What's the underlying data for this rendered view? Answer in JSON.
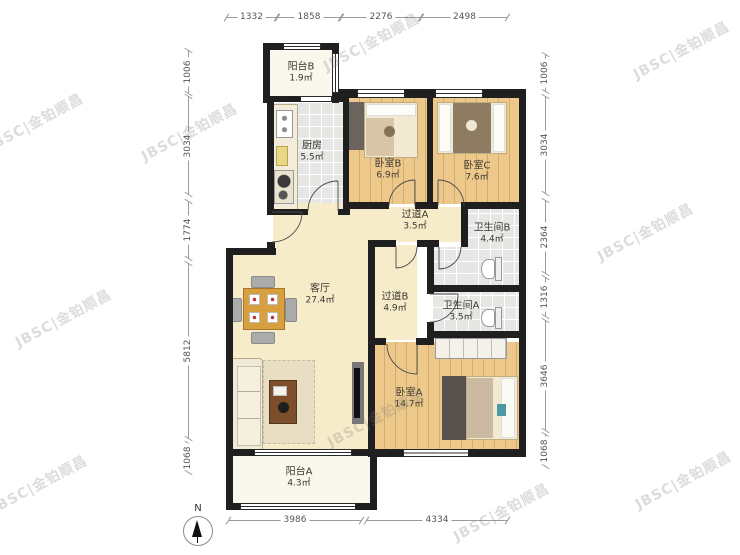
{
  "watermark": {
    "text": "JBSC|金铂顺昌"
  },
  "compass": {
    "north_label": "N"
  },
  "rooms": {
    "balcony_b": {
      "name": "阳台B",
      "area": "1.9㎡"
    },
    "kitchen": {
      "name": "厨房",
      "area": "5.5㎡"
    },
    "bedroom_b": {
      "name": "卧室B",
      "area": "6.9㎡"
    },
    "bedroom_c": {
      "name": "卧室C",
      "area": "7.6㎡"
    },
    "corridor_a": {
      "name": "过道A",
      "area": "3.5㎡"
    },
    "bath_b": {
      "name": "卫生间B",
      "area": "4.4㎡"
    },
    "living": {
      "name": "客厅",
      "area": "27.4㎡"
    },
    "corridor_b": {
      "name": "过道B",
      "area": "4.9㎡"
    },
    "bath_a": {
      "name": "卫生间A",
      "area": "3.5㎡"
    },
    "bedroom_a": {
      "name": "卧室A",
      "area": "14.7㎡"
    },
    "balcony_a": {
      "name": "阳台A",
      "area": "4.3㎡"
    }
  },
  "dims": {
    "top": [
      "1332",
      "1858",
      "2276",
      "2498"
    ],
    "bottom": [
      "3986",
      "4334"
    ],
    "left": [
      "1006",
      "3034",
      "1774",
      "5812",
      "1068"
    ],
    "right": [
      "1006",
      "3034",
      "2364",
      "1316",
      "3646",
      "1068"
    ]
  },
  "palette": {
    "wall": "#1f1f1f",
    "wood_floor": "#ecc98b",
    "tile_floor": "#e6e6e4",
    "cream_floor": "#f7ecca",
    "balcony_floor": "#faf7ec",
    "dim_text": "#555555",
    "watermark": "#7d7d7d"
  }
}
